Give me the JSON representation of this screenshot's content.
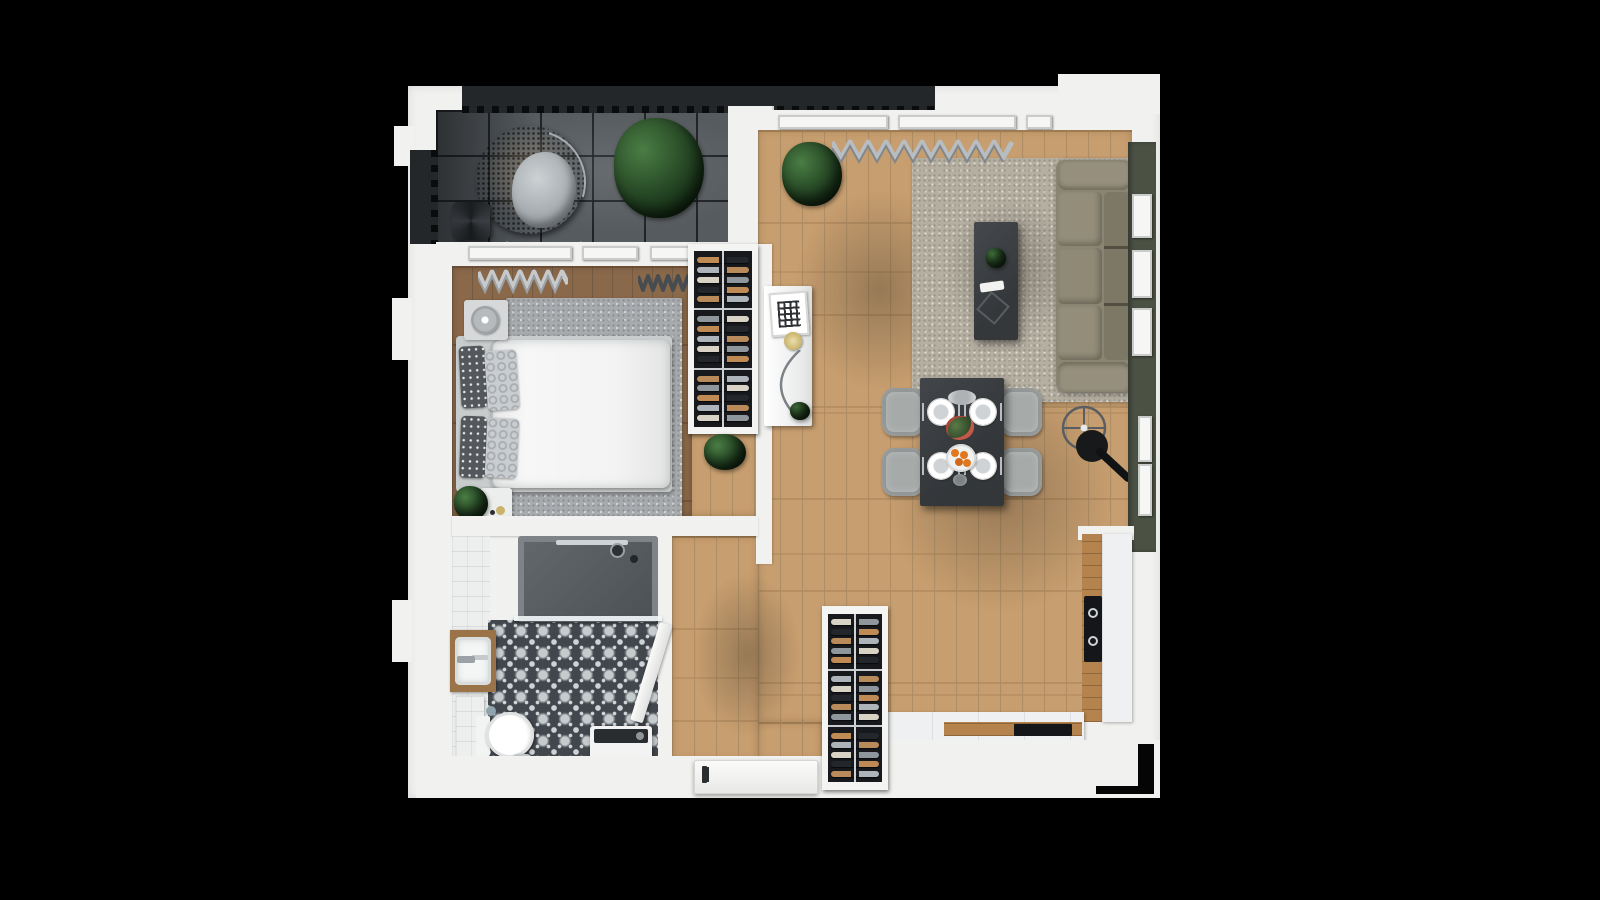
{
  "scene": {
    "title": "Top-down 3D apartment floor plan render",
    "background": "#000000",
    "rooms": [
      {
        "id": "balcony",
        "label": "Balcony"
      },
      {
        "id": "living-room",
        "label": "Living room"
      },
      {
        "id": "kitchen",
        "label": "Kitchen"
      },
      {
        "id": "bedroom",
        "label": "Bedroom"
      },
      {
        "id": "bathroom",
        "label": "Bathroom"
      },
      {
        "id": "hallway",
        "label": "Entry hallway"
      }
    ]
  },
  "palette": {
    "bg": "#000000",
    "wall": "#f1f1ef",
    "wallShade": "#dededc",
    "balconyTile": "#565b5f",
    "railing": "#24272a",
    "woodLight": "#c79e6f",
    "woodDark": "#8a684a",
    "rugLiving": "#b5afa2",
    "rugBedroom": "#a8abae",
    "sofa": "#8a8472",
    "greenWall": "#4b5244",
    "darkFurniture": "#3a3e41",
    "chair": "#a6aaa9",
    "tileBase": "#42474d",
    "tileMotif": "#d2d6d9",
    "counterWood": "#b5834d",
    "bathCounterWood": "#9a7348",
    "appliance": "#141619",
    "plantDark": "#1d3a1d",
    "plantLight": "#4a7d44",
    "orange": "#e07820"
  },
  "wine_racks": {
    "config": {
      "sections": 3,
      "rows_per_section": 5
    },
    "bottle_colors": [
      "#c08a55",
      "#aeb5ba",
      "#d9d3c6",
      "#23262a",
      "#b98b5a",
      "#8f979d"
    ]
  },
  "titles": {
    "balcony": "Balcony with hanging egg chair",
    "living": "Living room",
    "bedroom": "Bedroom",
    "bathroom": "Bathroom",
    "hallway": "Entry hallway",
    "kitchen": "Kitchen",
    "sofa": "Three-seat sofa",
    "rug": "Living room rug",
    "island": "Coffee table",
    "dining": "Dining table set for four",
    "lamp": "Floor lamp",
    "bed": "Double bed",
    "eggchair": "Hanging egg chair",
    "shower": "Walk-in shower",
    "toilet": "Toilet",
    "washer": "Washing machine",
    "rack": "Wine rack",
    "console": "Media console",
    "door": "Entry door",
    "cooktop": "Cooktop"
  }
}
